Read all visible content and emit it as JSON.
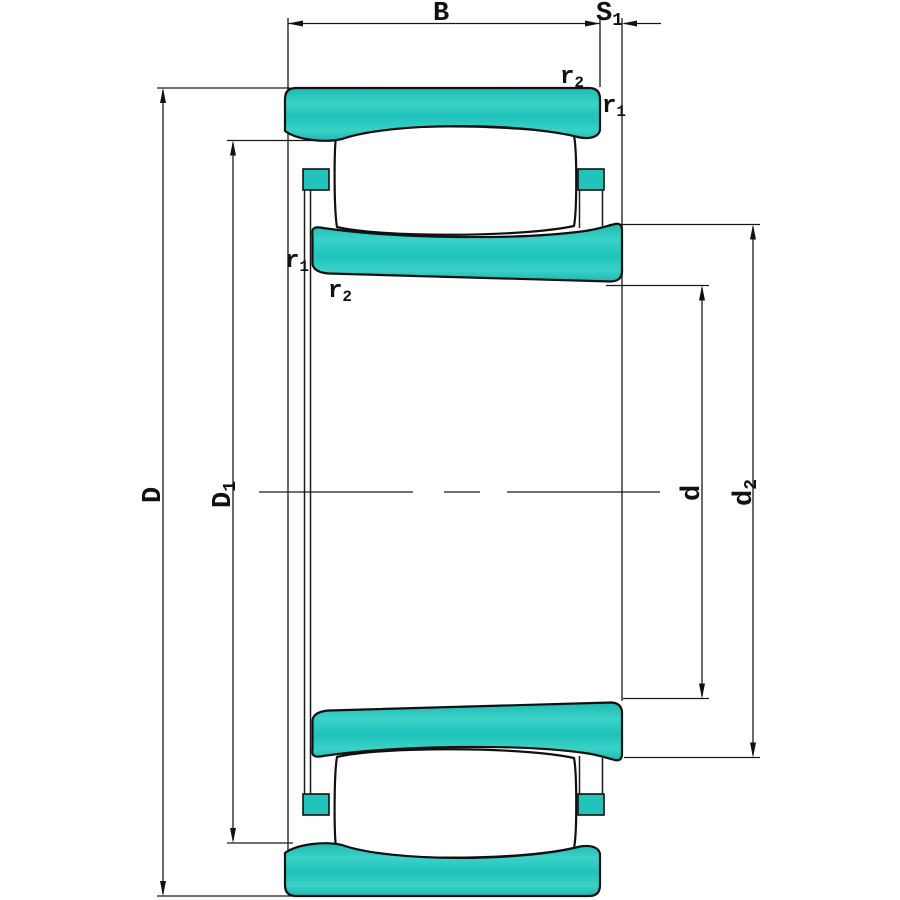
{
  "diagram": {
    "type": "toroidal-roller-bearing-cross-section",
    "background_color": "#ffffff",
    "line_color": "#111111",
    "ring_fill_color": "#22c3ba",
    "ring_fill_highlight_color": "#45d6cc",
    "labels": {
      "B": {
        "base": "B",
        "sub": ""
      },
      "S1": {
        "base": "S",
        "sub": "1"
      },
      "D": {
        "base": "D",
        "sub": ""
      },
      "D1": {
        "base": "D",
        "sub": "1"
      },
      "d": {
        "base": "d",
        "sub": ""
      },
      "d2": {
        "base": "d",
        "sub": "2"
      },
      "r1": {
        "base": "r",
        "sub": "1"
      },
      "r2": {
        "base": "r",
        "sub": "2"
      }
    }
  }
}
